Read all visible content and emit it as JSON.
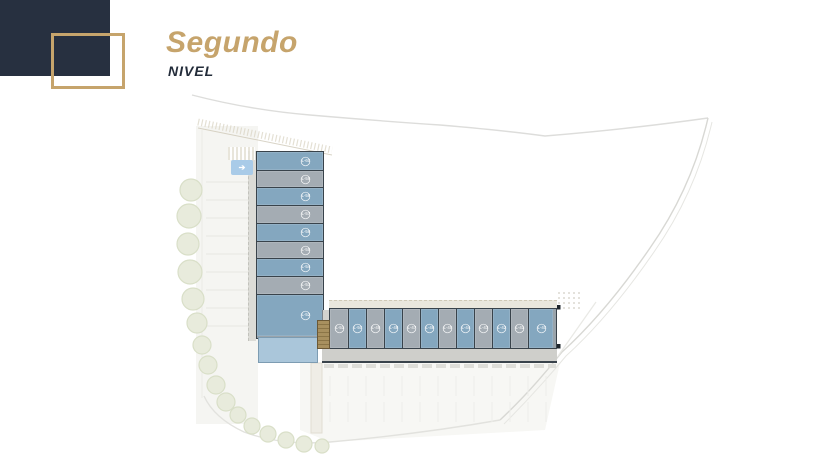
{
  "header": {
    "title": "Segundo",
    "subtitle": "NIVEL"
  },
  "colors": {
    "accent_gold": "#c6a46c",
    "navy": "#273040",
    "unit_blue": "#84a7bf",
    "unit_gray": "#a4acb3"
  },
  "plan": {
    "entrance_arrow": "➔",
    "vertical_units": [
      {
        "label": "L-60",
        "variant": "blue",
        "h": 18
      },
      {
        "label": "L-59",
        "variant": "gray",
        "h": 17
      },
      {
        "label": "L-58",
        "variant": "blue",
        "h": 18
      },
      {
        "label": "L-57",
        "variant": "gray",
        "h": 18
      },
      {
        "label": "L-56",
        "variant": "blue",
        "h": 18
      },
      {
        "label": "L-55",
        "variant": "gray",
        "h": 17
      },
      {
        "label": "L-54",
        "variant": "blue",
        "h": 18
      },
      {
        "label": "L-53",
        "variant": "gray",
        "h": 18
      },
      {
        "label": "L-52",
        "variant": "blue",
        "h": 42
      }
    ],
    "horizontal_units": [
      {
        "label": "L-51",
        "variant": "gray",
        "w": 18
      },
      {
        "label": "L-50",
        "variant": "blue",
        "w": 18
      },
      {
        "label": "L-49",
        "variant": "gray",
        "w": 18
      },
      {
        "label": "L-48",
        "variant": "blue",
        "w": 18
      },
      {
        "label": "L-47",
        "variant": "gray",
        "w": 18
      },
      {
        "label": "L-46",
        "variant": "blue",
        "w": 18
      },
      {
        "label": "L-45",
        "variant": "gray",
        "w": 18
      },
      {
        "label": "L-44",
        "variant": "blue",
        "w": 18
      },
      {
        "label": "L-43",
        "variant": "gray",
        "w": 18
      },
      {
        "label": "L-42",
        "variant": "blue",
        "w": 18
      },
      {
        "label": "L-41",
        "variant": "gray",
        "w": 18
      },
      {
        "label": "L-40",
        "variant": "blue",
        "w": 25
      }
    ]
  }
}
